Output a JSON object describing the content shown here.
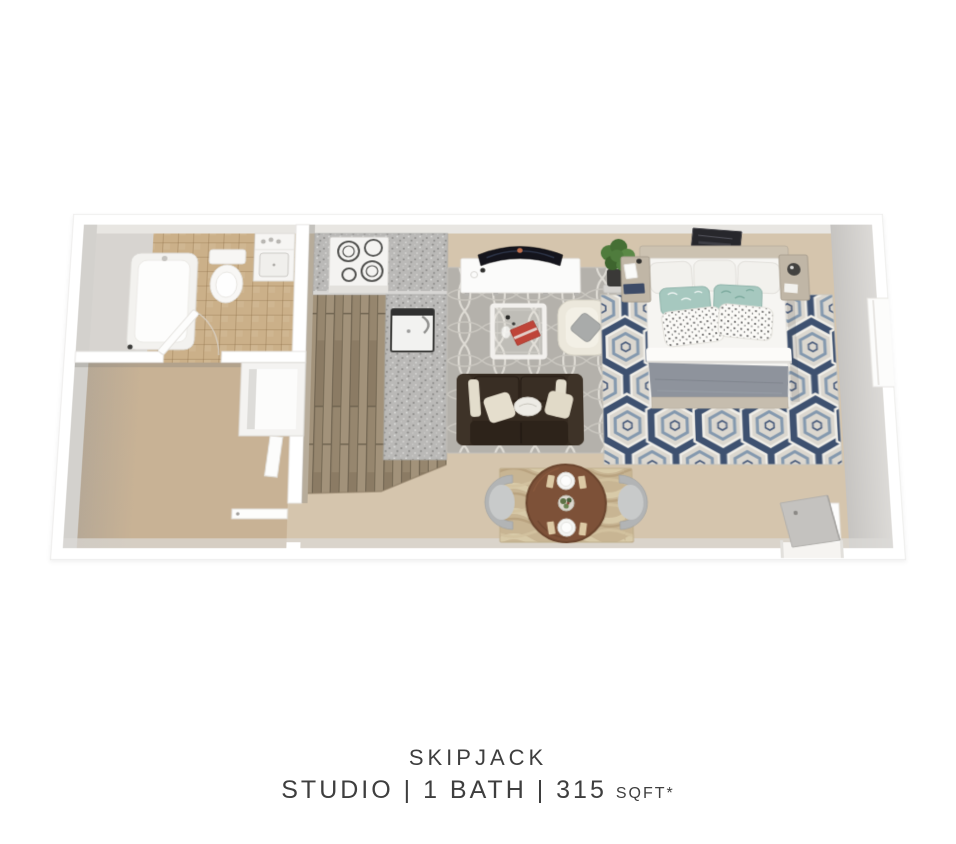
{
  "page": {
    "background": "#ffffff"
  },
  "caption": {
    "title": "SKIPJACK",
    "details": "STUDIO | 1 BATH | 315",
    "sqft": "SQFT*",
    "text_color": "#3e3e3e"
  },
  "floorplan": {
    "type": "3d-floor-plan",
    "unit_name": "Skipjack",
    "rooms": [
      "bathroom",
      "kitchen",
      "living-area",
      "sleeping-area",
      "dining-nook",
      "flex-room"
    ],
    "furniture": [
      "bathtub",
      "toilet",
      "vanity-sink",
      "range-stove",
      "kitchen-sink",
      "tv-console",
      "curved-tv",
      "potted-plant",
      "trellis-rug",
      "coffee-table",
      "armchair",
      "sofa",
      "dining-table",
      "dining-chairs",
      "bed",
      "nightstands",
      "wall-art",
      "hex-pattern-rug",
      "closet",
      "entry-door",
      "window"
    ]
  },
  "colors": {
    "wall": "#ffffff",
    "wall_face": "#d3d1cd",
    "carpet": "#d5c5ad",
    "carpet_flex": "#c8b295",
    "tile": "#cbb089",
    "wood": "#96866e",
    "granite": "#bab9b7",
    "rug_living": "#b4b1ab",
    "rug_dining": "#c8b593",
    "rug_bed_field": "#dbd7cf",
    "rug_bed_navy": "#3e5170",
    "rug_bed_blue": "#8398ae",
    "sofa": "#362b21",
    "armchair": "#ece8dc",
    "console": "#fbfbfa",
    "tv": "#14141c",
    "plant": "#4f7c3d",
    "book_red": "#bf4438",
    "table_wood": "#7d5138",
    "chair_gray": "#b2b4b5",
    "bed_sheet": "#f6f5f2",
    "bed_blanket": "#8e939c",
    "pillow_teal": "#a6c8bf",
    "headboard": "#ccc2b1",
    "nightstand": "#c0b6a6",
    "door_gray": "#c4c2bf"
  }
}
